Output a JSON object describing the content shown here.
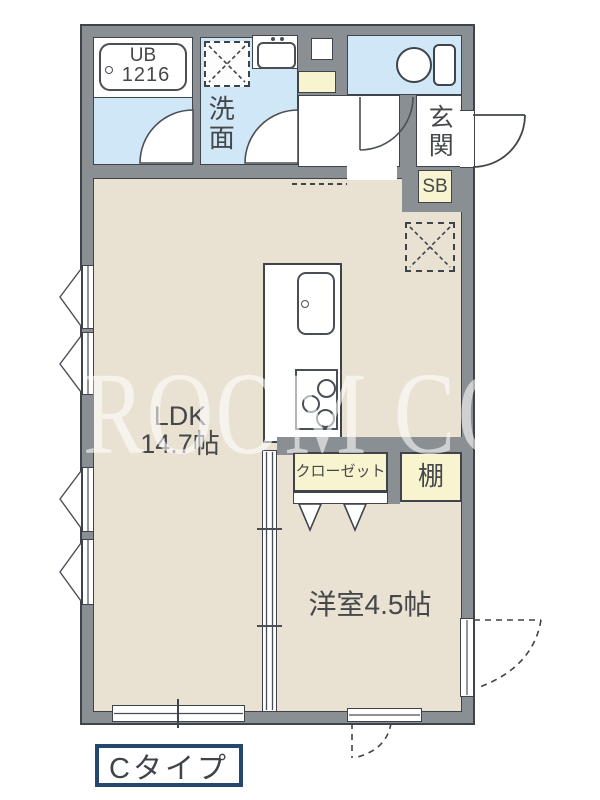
{
  "plan": {
    "watermark": "ROOM CORE",
    "type_label": "Cタイプ",
    "colors": {
      "wall": "#8a8f94",
      "floor": "#e9e2d3",
      "wet_area": "#cfe7f7",
      "storage": "#f8f4cf",
      "outline": "#3f444a",
      "type_border": "#24476e"
    },
    "rooms": {
      "bath": {
        "name": "UB",
        "size": "1216"
      },
      "washroom": {
        "label": "洗面"
      },
      "entrance": {
        "label": "玄関"
      },
      "shoebox": {
        "label": "SB"
      },
      "ldk": {
        "label": "LDK",
        "area": "14.7帖"
      },
      "closet": {
        "label": "クローゼット"
      },
      "shelf": {
        "label": "棚"
      },
      "western_room": {
        "label": "洋室4.5帖"
      }
    }
  }
}
